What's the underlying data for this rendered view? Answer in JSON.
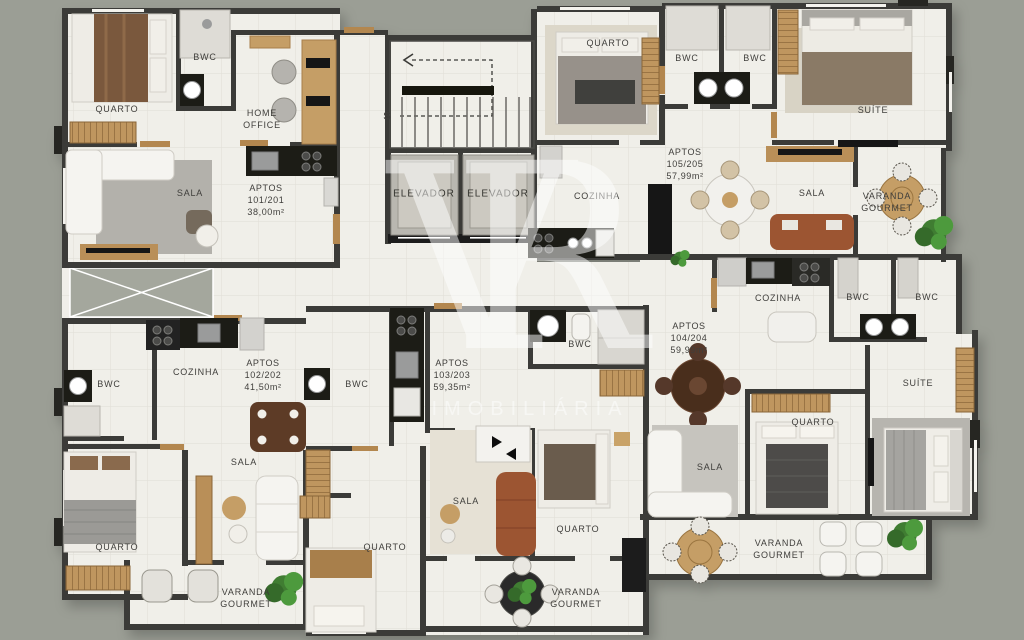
{
  "colors": {
    "background": "#9b9e95",
    "floor": "#f0efe9",
    "wall": "#3a3a37",
    "wood": "#c59e66",
    "counter_black": "#1b1b19",
    "terracotta_sofa": "#9c5433",
    "plant_green": "#4e9a3e",
    "watermark_white": "#ffffff"
  },
  "watermark": {
    "logo_v": "V",
    "logo_r": "R",
    "brand": "IMOBILIÁRIA"
  },
  "core": {
    "stair_label": "S",
    "elevator_1": "ELEVADOR",
    "elevator_2": "ELEVADOR"
  },
  "apartments": {
    "apt_101_201": {
      "name": "APTOS\n101/201\n38,00m²",
      "rooms": {
        "quarto": "QUARTO",
        "bwc": "BWC",
        "home_office": "HOME\nOFFICE",
        "sala": "SALA"
      }
    },
    "apt_102_202": {
      "name": "APTOS\n102/202\n41,50m²",
      "rooms": {
        "bwc": "BWC",
        "cozinha": "COZINHA",
        "sala": "SALA",
        "quarto": "QUARTO",
        "varanda": "VARANDA\nGOURMET"
      }
    },
    "apt_103_203": {
      "name": "APTOS\n103/203\n59,35m²",
      "rooms": {
        "bwc_1": "BWC",
        "bwc_2": "BWC",
        "sala": "SALA",
        "quarto_1": "QUARTO",
        "quarto_2": "QUARTO",
        "varanda": "VARANDA\nGOURMET"
      }
    },
    "apt_104_204": {
      "name": "APTOS\n104/204\n59,99m²",
      "rooms": {
        "cozinha": "COZINHA",
        "bwc_1": "BWC",
        "bwc_2": "BWC",
        "suite": "SUÍTE",
        "quarto": "QUARTO",
        "sala": "SALA",
        "varanda": "VARANDA\nGOURMET"
      }
    },
    "apt_105_205": {
      "name": "APTOS\n105/205\n57,99m²",
      "rooms": {
        "quarto": "QUARTO",
        "cozinha": "COZINHA",
        "bwc_1": "BWC",
        "bwc_2": "BWC",
        "sala": "SALA",
        "suite": "SUÍTE",
        "varanda": "VARANDA\nGOURMET"
      }
    }
  }
}
